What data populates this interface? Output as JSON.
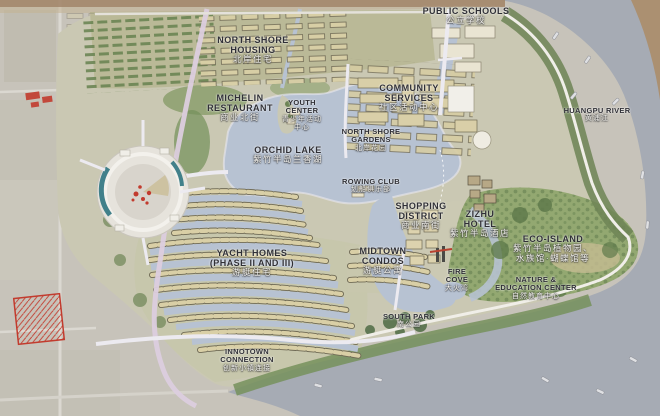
{
  "map": {
    "title": "Zizhu Peninsula waterfront masterplan",
    "colors": {
      "background": "#c7c3ba",
      "river_water": "#a6abb4",
      "lake_water": "#b7c2d2",
      "site_ground": "#cac8b3",
      "green_dark": "#5f7a4b",
      "green_mid": "#7f955f",
      "housing_tan": "#d9cfa6",
      "road_light": "#eceaf0",
      "accent_red": "#c23b2e",
      "accent_teal": "#41808a",
      "bank_brown": "#ab9071"
    },
    "labels": [
      {
        "id": "public-schools",
        "size": "lg",
        "x": 466,
        "y": 6,
        "en": [
          "PUBLIC SCHOOLS"
        ],
        "zh": [
          "公立学校"
        ]
      },
      {
        "id": "huangpu-river",
        "size": "sm",
        "x": 597,
        "y": 107,
        "en": [
          "HUANGPU RIVER"
        ],
        "zh": [
          "黄浦江"
        ]
      },
      {
        "id": "north-shore-housing",
        "size": "lg",
        "x": 253,
        "y": 35,
        "en": [
          "NORTH SHORE",
          "HOUSING"
        ],
        "zh": [
          "北岸住宅"
        ]
      },
      {
        "id": "michelin-restaurant",
        "size": "lg",
        "x": 240,
        "y": 93,
        "en": [
          "MICHELIN",
          "RESTAURANT"
        ],
        "zh": [
          "商业北街"
        ]
      },
      {
        "id": "youth-center",
        "size": "sm",
        "x": 302,
        "y": 99,
        "en": [
          "YOUTH",
          "CENTER"
        ],
        "zh": [
          "青少年活动",
          "中心"
        ]
      },
      {
        "id": "community-services",
        "size": "lg",
        "x": 409,
        "y": 83,
        "en": [
          "COMMUNITY",
          "SERVICES"
        ],
        "zh": [
          "社区活动中心"
        ]
      },
      {
        "id": "north-shore-gardens",
        "size": "sm",
        "x": 371,
        "y": 128,
        "en": [
          "NORTH SHORE",
          "GARDENS"
        ],
        "zh": [
          "北岸花园"
        ]
      },
      {
        "id": "orchid-lake",
        "size": "lg",
        "x": 288,
        "y": 145,
        "en": [
          "ORCHID LAKE"
        ],
        "zh": [
          "紫竹半岛兰香湖"
        ]
      },
      {
        "id": "rowing-club",
        "size": "sm",
        "x": 371,
        "y": 178,
        "en": [
          "ROWING CLUB"
        ],
        "zh": [
          "划船俱乐部"
        ]
      },
      {
        "id": "shopping-district",
        "size": "lg",
        "x": 421,
        "y": 201,
        "en": [
          "SHOPPING",
          "DISTRICT"
        ],
        "zh": [
          "商业南街"
        ]
      },
      {
        "id": "zizhu-hotel",
        "size": "lg",
        "x": 480,
        "y": 209,
        "en": [
          "ZIZHU",
          "HOTEL"
        ],
        "zh": [
          "紫竹半岛酒店"
        ]
      },
      {
        "id": "eco-island",
        "size": "lg",
        "x": 553,
        "y": 234,
        "en": [
          "ECO-ISLAND"
        ],
        "zh": [
          "紫竹半岛植物园、",
          "水族馆·蝴蝶馆等"
        ]
      },
      {
        "id": "nature-education-center",
        "size": "sm",
        "x": 536,
        "y": 276,
        "en": [
          "NATURE &",
          "EDUCATION CENTER"
        ],
        "zh": [
          "自然教育中心"
        ]
      },
      {
        "id": "midtown-condos",
        "size": "lg",
        "x": 383,
        "y": 246,
        "en": [
          "MIDTOWN",
          "CONDOS"
        ],
        "zh": [
          "游艇公寓"
        ]
      },
      {
        "id": "fire-cove",
        "size": "sm",
        "x": 457,
        "y": 268,
        "en": [
          "FIRE",
          "COVE"
        ],
        "zh": [
          "大火湾"
        ]
      },
      {
        "id": "south-park",
        "size": "sm",
        "x": 409,
        "y": 313,
        "en": [
          "SOUTH PARK"
        ],
        "zh": [
          "南公园"
        ]
      },
      {
        "id": "yacht-homes",
        "size": "lg",
        "x": 252,
        "y": 248,
        "en": [
          "YACHT HOMES",
          "(PHASE II AND III)"
        ],
        "zh": [
          "游艇住宅"
        ]
      },
      {
        "id": "innotown-connection",
        "size": "sm",
        "x": 247,
        "y": 348,
        "en": [
          "INNOTOWN",
          "CONNECTION"
        ],
        "zh": [
          "创新小镇连接"
        ]
      }
    ]
  }
}
